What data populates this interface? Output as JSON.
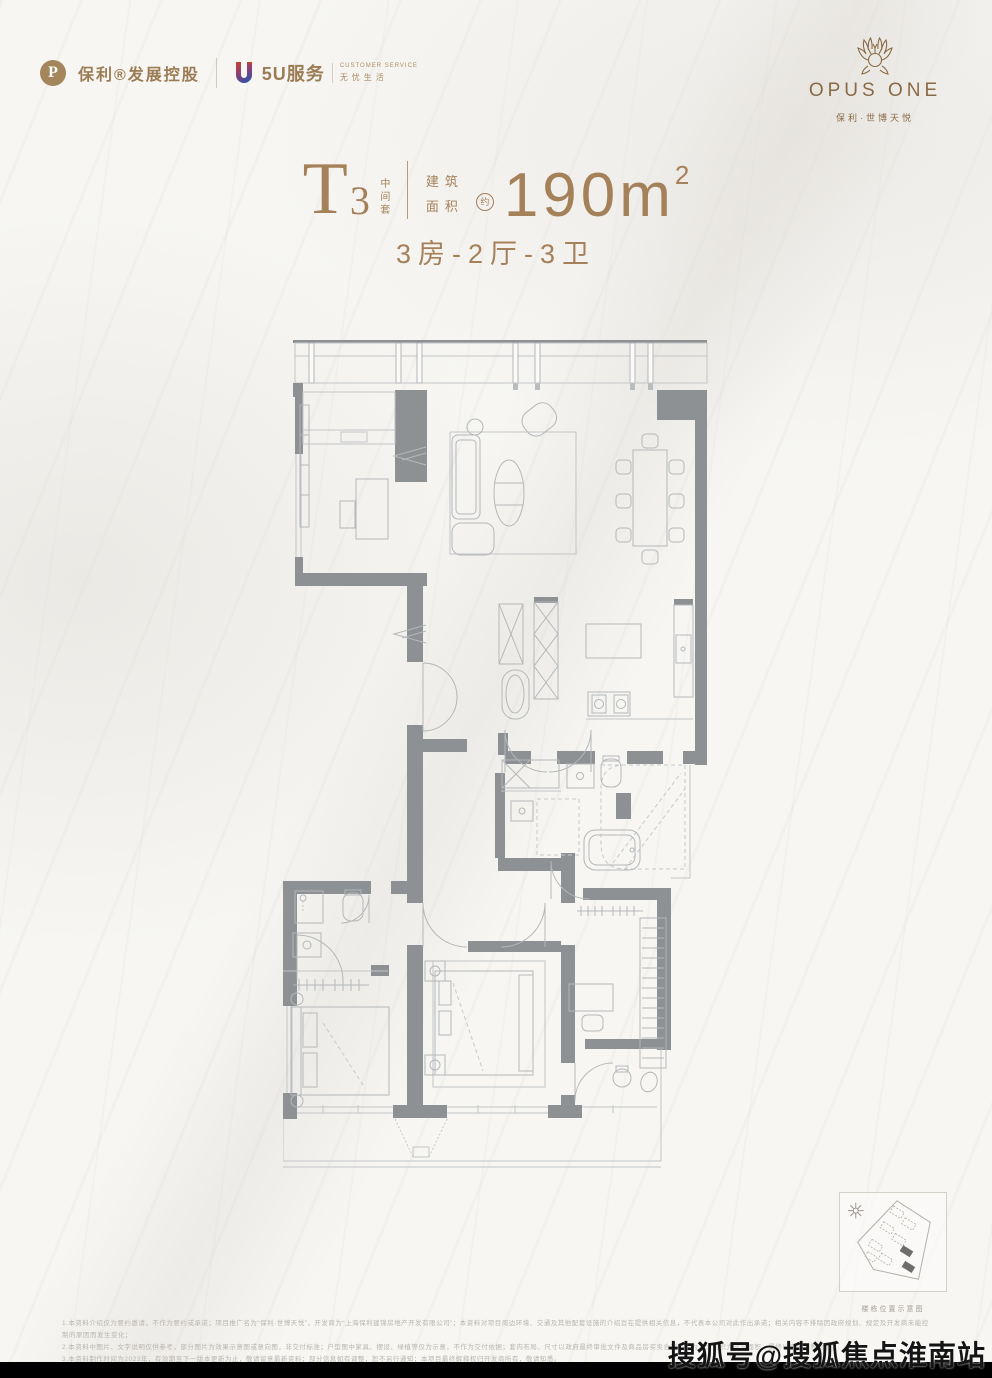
{
  "header": {
    "poly_text": "保利®发展控股",
    "poly_icon": "P",
    "service_name": "5U服务",
    "service_tag_top": "CUSTOMER SERVICE",
    "service_tag_bottom": "无忧生活",
    "brand_title": "OPUS ONE",
    "brand_subtitle": "保利·世博天悦"
  },
  "title_block": {
    "unit_letter": "T",
    "unit_digit": "3",
    "unit_tag": "中间套",
    "area_label_1": "建筑",
    "area_label_2": "面积",
    "approx": "约",
    "area_value": "190m",
    "area_sup": "2",
    "layout_summary": "3房-2厅-3卫"
  },
  "keyplan": {
    "caption": "楼栋位置示意图"
  },
  "disclaimer": {
    "lines": [
      "1.本资料介绍仅为要约邀请，不作为要约或承诺；项目推广名为“保利·世博天悦”，开发商为“上海保利建锦房地产开发有限公司”；本资料对项目周边环境、交通及其他配套设施的介绍旨在提供相关信息，不代表本公司对此作出承诺；相关内容不排除因政府规划、规定及开发商未能控制的原因而发生变化；",
      "2.本资料中图片、文字说明仅供参考，部分图片为效果示意图或意向图，非交付标准；户型图中家具、摆设、绿植等仅为示意，不作为交付依据；套内布局、尺寸以政府最终审批文件及商品房买卖合同约定为准；面积为建筑面积，最终以实测面积为准；",
      "3.本资料制作时间为2023年，有效期至下一版本更新为止，敬请留意最新资料；部分信息如有调整，恕不另行通知；本项目最终解释权归开发商所有，敬请知悉。"
    ]
  },
  "watermark": {
    "text": "搜狐号@搜狐焦点淮南站"
  },
  "colors": {
    "gold": "#a5815a",
    "brand_brown": "#8a6a46",
    "wall_gray": "#8d9194",
    "line_gray": "#c2c5c7",
    "bar_black": "#000000",
    "service_gradient_top": "#c8452c",
    "service_gradient_bottom": "#3c4fa0"
  }
}
